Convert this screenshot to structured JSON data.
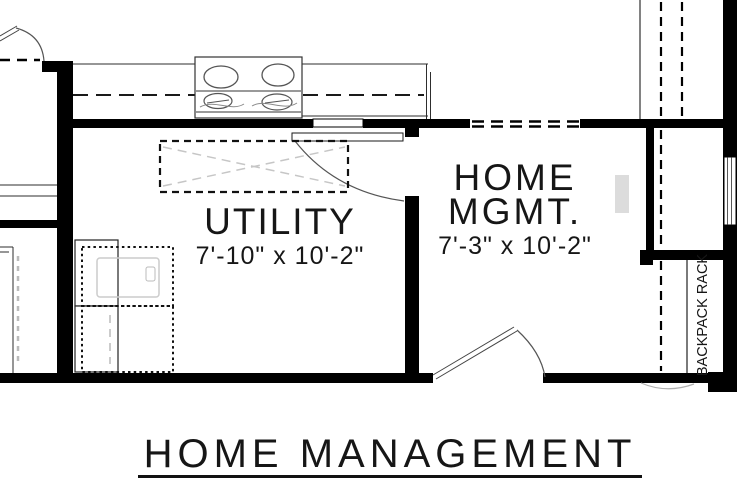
{
  "title": {
    "label": "HOME MANAGEMENT"
  },
  "rooms": {
    "utility": {
      "name": "UTILITY",
      "dimensions": "7'-10\" x 10'-2\""
    },
    "home_mgmt": {
      "name_line1": "HOME",
      "name_line2": "MGMT.",
      "dimensions": "7'-3\" x 10'-2\""
    },
    "backpack_rack": {
      "label": "BACKPACK RACK"
    }
  },
  "colors": {
    "wall": "#000000",
    "thin_line": "#2e2e2e",
    "faint_line": "#c6c6c6",
    "fixture_gray": "#dcdcdc",
    "text": "#161616",
    "background": "#ffffff"
  }
}
